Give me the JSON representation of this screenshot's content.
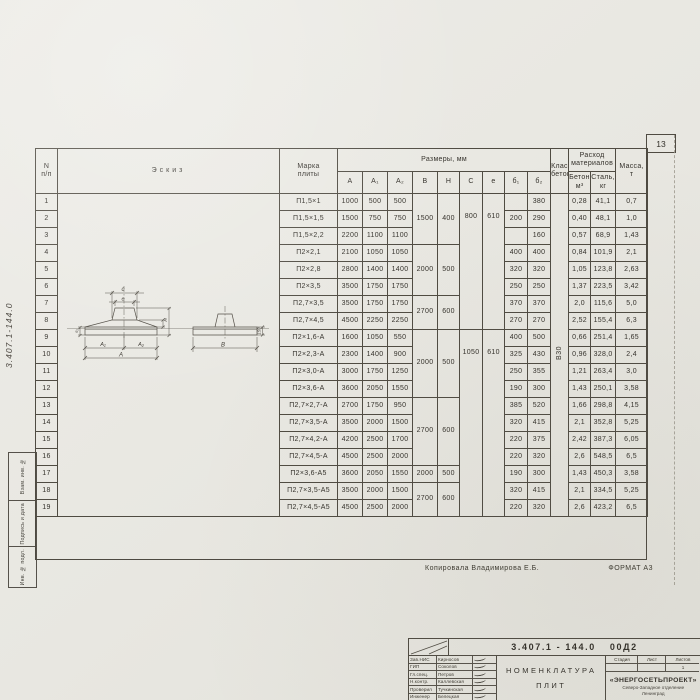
{
  "page": {
    "sheet_number": "13",
    "margin_doc_label": "3.407.1-144.0",
    "margin_stamps": [
      "Взам. инв. №",
      "Подпись и дата",
      "Инв. № подл."
    ],
    "copy_note": "Копировала Владимирова Е.Б.",
    "format_note": "ФОРМАТ А3"
  },
  "table": {
    "headers": {
      "num": "N\nп/п",
      "sketch": "Эскиз",
      "mark": "Марка\nплиты",
      "dims_group": "Размеры, мм",
      "dims": [
        "A",
        "A₁",
        "A₂",
        "B",
        "H",
        "C",
        "e",
        "б₁",
        "б₂"
      ],
      "concrete_class": "Класс\nбетона",
      "materials_group": "Расход\nматериалов",
      "materials": [
        "Бетон,\nм³",
        "Сталь,\nкг"
      ],
      "mass": "Масса,\nт"
    },
    "concrete_class_value": "В30",
    "rows": [
      {
        "n": "1",
        "mark": "П1,5×1",
        "A": "1000",
        "A1": "500",
        "A2": "500",
        "b1": "",
        "b2": "380",
        "concrete": "0,28",
        "steel": "41,1",
        "mass": "0,7"
      },
      {
        "n": "2",
        "mark": "П1,5×1,5",
        "A": "1500",
        "A1": "750",
        "A2": "750",
        "b1": "200",
        "b2": "290",
        "concrete": "0,40",
        "steel": "48,1",
        "mass": "1,0"
      },
      {
        "n": "3",
        "mark": "П1,5×2,2",
        "A": "2200",
        "A1": "1100",
        "A2": "1100",
        "b1": "",
        "b2": "160",
        "concrete": "0,57",
        "steel": "68,9",
        "mass": "1,43"
      },
      {
        "n": "4",
        "mark": "П2×2,1",
        "A": "2100",
        "A1": "1050",
        "A2": "1050",
        "b1": "400",
        "b2": "400",
        "concrete": "0,84",
        "steel": "101,9",
        "mass": "2,1"
      },
      {
        "n": "5",
        "mark": "П2×2,8",
        "A": "2800",
        "A1": "1400",
        "A2": "1400",
        "b1": "320",
        "b2": "320",
        "concrete": "1,05",
        "steel": "123,8",
        "mass": "2,63"
      },
      {
        "n": "6",
        "mark": "П2×3,5",
        "A": "3500",
        "A1": "1750",
        "A2": "1750",
        "b1": "250",
        "b2": "250",
        "concrete": "1,37",
        "steel": "223,5",
        "mass": "3,42"
      },
      {
        "n": "7",
        "mark": "П2,7×3,5",
        "A": "3500",
        "A1": "1750",
        "A2": "1750",
        "b1": "370",
        "b2": "370",
        "concrete": "2,0",
        "steel": "115,6",
        "mass": "5,0"
      },
      {
        "n": "8",
        "mark": "П2,7×4,5",
        "A": "4500",
        "A1": "2250",
        "A2": "2250",
        "b1": "270",
        "b2": "270",
        "concrete": "2,52",
        "steel": "155,4",
        "mass": "6,3"
      },
      {
        "n": "9",
        "mark": "П2×1,6-А",
        "A": "1600",
        "A1": "1050",
        "A2": "550",
        "b1": "400",
        "b2": "500",
        "concrete": "0,66",
        "steel": "251,4",
        "mass": "1,65"
      },
      {
        "n": "10",
        "mark": "П2×2,3-А",
        "A": "2300",
        "A1": "1400",
        "A2": "900",
        "b1": "325",
        "b2": "430",
        "concrete": "0,96",
        "steel": "328,0",
        "mass": "2,4"
      },
      {
        "n": "11",
        "mark": "П2×3,0-А",
        "A": "3000",
        "A1": "1750",
        "A2": "1250",
        "b1": "250",
        "b2": "355",
        "concrete": "1,21",
        "steel": "263,4",
        "mass": "3,0"
      },
      {
        "n": "12",
        "mark": "П2×3,6-А",
        "A": "3600",
        "A1": "2050",
        "A2": "1550",
        "b1": "190",
        "b2": "300",
        "concrete": "1,43",
        "steel": "250,1",
        "mass": "3,58"
      },
      {
        "n": "13",
        "mark": "П2,7×2,7-А",
        "A": "2700",
        "A1": "1750",
        "A2": "950",
        "b1": "385",
        "b2": "520",
        "concrete": "1,66",
        "steel": "298,8",
        "mass": "4,15"
      },
      {
        "n": "14",
        "mark": "П2,7×3,5-А",
        "A": "3500",
        "A1": "2000",
        "A2": "1500",
        "b1": "320",
        "b2": "415",
        "concrete": "2,1",
        "steel": "352,8",
        "mass": "5,25"
      },
      {
        "n": "15",
        "mark": "П2,7×4,2-А",
        "A": "4200",
        "A1": "2500",
        "A2": "1700",
        "b1": "220",
        "b2": "375",
        "concrete": "2,42",
        "steel": "387,3",
        "mass": "6,05"
      },
      {
        "n": "16",
        "mark": "П2,7×4,5-А",
        "A": "4500",
        "A1": "2500",
        "A2": "2000",
        "b1": "220",
        "b2": "320",
        "concrete": "2,6",
        "steel": "548,5",
        "mass": "6,5"
      },
      {
        "n": "17",
        "mark": "П2×3,6-А5",
        "A": "3600",
        "A1": "2050",
        "A2": "1550",
        "b1": "190",
        "b2": "300",
        "concrete": "1,43",
        "steel": "450,3",
        "mass": "3,58"
      },
      {
        "n": "18",
        "mark": "П2,7×3,5-А5",
        "A": "3500",
        "A1": "2000",
        "A2": "1500",
        "b1": "320",
        "b2": "415",
        "concrete": "2,1",
        "steel": "334,5",
        "mass": "5,25"
      },
      {
        "n": "19",
        "mark": "П2,7×4,5-А5",
        "A": "4500",
        "A1": "2500",
        "A2": "2000",
        "b1": "220",
        "b2": "320",
        "concrete": "2,6",
        "steel": "423,2",
        "mass": "6,5"
      }
    ],
    "merged": {
      "B": [
        {
          "from": 1,
          "to": 3,
          "v": "1500"
        },
        {
          "from": 4,
          "to": 6,
          "v": "2000"
        },
        {
          "from": 7,
          "to": 8,
          "v": "2700"
        },
        {
          "from": 9,
          "to": 12,
          "v": "2000"
        },
        {
          "from": 13,
          "to": 16,
          "v": "2700"
        },
        {
          "from": 17,
          "to": 17,
          "v": "2000"
        },
        {
          "from": 18,
          "to": 19,
          "v": "2700"
        }
      ],
      "H": [
        {
          "from": 1,
          "to": 3,
          "v": "400"
        },
        {
          "from": 4,
          "to": 6,
          "v": "500"
        },
        {
          "from": 7,
          "to": 8,
          "v": "600"
        },
        {
          "from": 9,
          "to": 12,
          "v": "500"
        },
        {
          "from": 13,
          "to": 16,
          "v": "600"
        },
        {
          "from": 17,
          "to": 17,
          "v": "500"
        },
        {
          "from": 18,
          "to": 19,
          "v": "600"
        }
      ],
      "C": [
        {
          "from": 1,
          "to": 8,
          "v": "800",
          "at": 2
        },
        {
          "from": 9,
          "to": 19,
          "v": "1050",
          "at": 10
        }
      ],
      "e": [
        {
          "from": 1,
          "to": 8,
          "v": "610",
          "at": 2
        },
        {
          "from": 9,
          "to": 19,
          "v": "610",
          "at": 10
        }
      ]
    }
  },
  "sketch": {
    "labels": {
      "c": "c",
      "e": "e",
      "a1": "A₁",
      "a2": "A₂",
      "a": "A",
      "b": "B",
      "h": "H",
      "b2": "б₂",
      "side": "150"
    }
  },
  "title_block": {
    "doc_number": "3.407.1 - 144.0",
    "doc_code": "00Д2",
    "title": "Номенклатура\nплит",
    "signers": [
      {
        "role": "Зав.НИС",
        "name": "Кирносов"
      },
      {
        "role": "ГИП",
        "name": "Соколов"
      },
      {
        "role": "Гл.спец.",
        "name": "Петров"
      },
      {
        "role": "Н.контр.",
        "name": "Каллевская"
      },
      {
        "role": "Проверил",
        "name": "Тучкинская"
      },
      {
        "role": "Инженер",
        "name": "Белецкая"
      }
    ],
    "stage_cols": [
      "Стадия",
      "Лист",
      "Листов"
    ],
    "sheets_total": "1",
    "org": "«ЭНЕРГОСЕТЬПРОЕКТ»",
    "org_branch": "Северо-Западное отделение",
    "org_city": "Ленинград"
  },
  "colors": {
    "line": "#4f4b42",
    "paper": "#e8e7e1",
    "ink": "#34312b"
  }
}
